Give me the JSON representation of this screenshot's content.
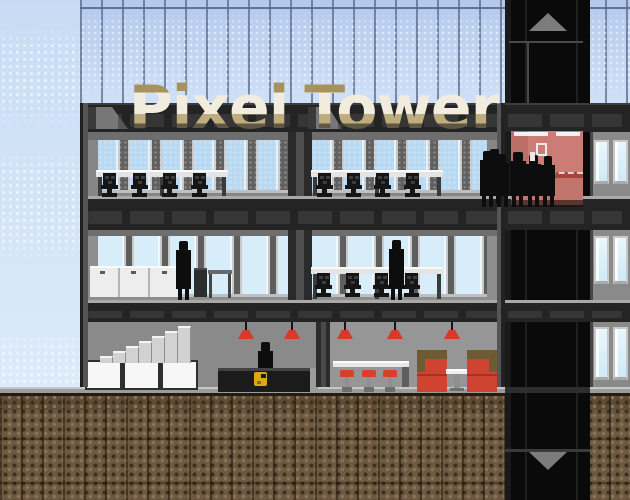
{
  "game": {
    "title": "Pixel Tower"
  },
  "logo": {
    "word1": "Pixel",
    "word2": "Tower"
  },
  "elevator": {
    "buttons": [
      {
        "icon": "up-arrow"
      },
      {
        "icon": "down-arrow"
      }
    ]
  },
  "colors": {
    "sky_top": "#c7dcf4",
    "sky_bottom": "#e3f0fc",
    "glass": "#b3c8ec",
    "glass_light": "#cfe0f7",
    "slab": "#242424",
    "slab_panel": "#363636",
    "window_blue": "#b9d9f2",
    "window_pale": "#d7edf9",
    "frame": "#c9c9c9",
    "ground": "#6e5a42",
    "shaft": "#0a0a0a",
    "arrow": "#7c7c7c",
    "pink": "#cb7d75",
    "pink_dark": "#bb6f68",
    "pink_base": "#a8443c",
    "lamp_red": "#d63b2a",
    "stool_red": "#d8402e",
    "booth_red": "#cf4430",
    "booth_olive": "#6b5c33",
    "gold": "#d9a916",
    "silhouette": "#0d0d0d",
    "logo_tan": "#a6925f",
    "logo_cream": "#f1ecdd",
    "logo_dark": "#5f5744",
    "logo_outline": "#131313"
  }
}
